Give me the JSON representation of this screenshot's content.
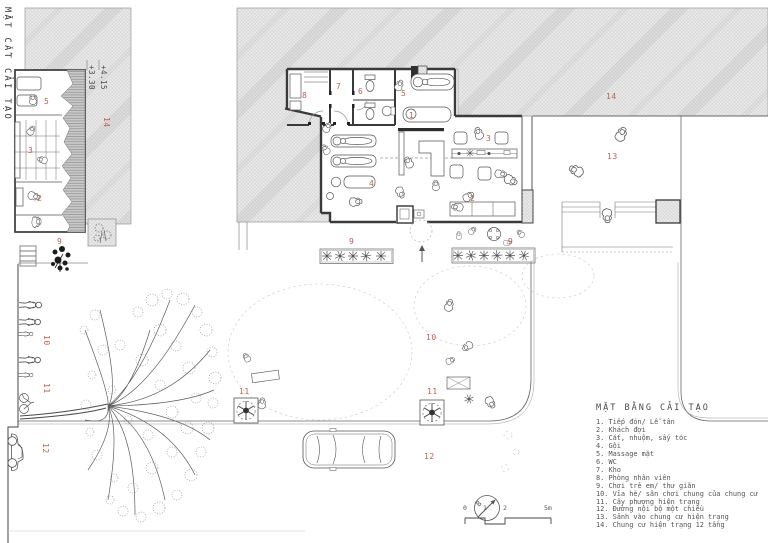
{
  "drawing": {
    "section_title": "MẶT CẮT CẢI TẠO"
  },
  "elevations": {
    "upper": "+4.15",
    "lower": "+3.30"
  },
  "labels": {
    "section": {
      "s5": "5",
      "s3": "3",
      "s2": "2",
      "s9": "9",
      "s14": "14",
      "s10": "10",
      "s11": "11",
      "s12": "12"
    },
    "plan": {
      "p1": "1",
      "p2": "2",
      "p3": "3",
      "p4": "4",
      "p5": "5",
      "p6": "6",
      "p7": "7",
      "p8": "8",
      "p9a": "9",
      "p9b": "9",
      "p10": "10",
      "p11a": "11",
      "p11b": "11",
      "p12": "12",
      "p13": "13",
      "p14": "14"
    }
  },
  "legend": {
    "title": "MẶT BẰNG CẢI TẠO",
    "items": [
      "1. Tiếp đón/ Lễ tân",
      "2. Khách đợi",
      "3. Cắt, nhuộm, sấy tóc",
      "4. Gội",
      "5. Massage mặt",
      "6. WC",
      "7. Kho",
      "8. Phòng nhân viên",
      "9. Chơi trẻ em/ thư giãn",
      "10. Vỉa hè/ sân chơi chung của chung cư",
      "11. Cây phượng hiện trạng",
      "12. Đường nội bộ một chiều",
      "13. Sảnh vào chung cư hiện trạng",
      "14. Chung cư hiện trạng 12 tầng"
    ]
  },
  "scalebar": {
    "t0": "0",
    "t1": "1",
    "t2": "2",
    "t5": "5m"
  },
  "north_label": "B",
  "colors": {
    "label_red": "#bf6157",
    "hatch_line": "#cfcfcf",
    "wall": "#3a3a3a"
  }
}
